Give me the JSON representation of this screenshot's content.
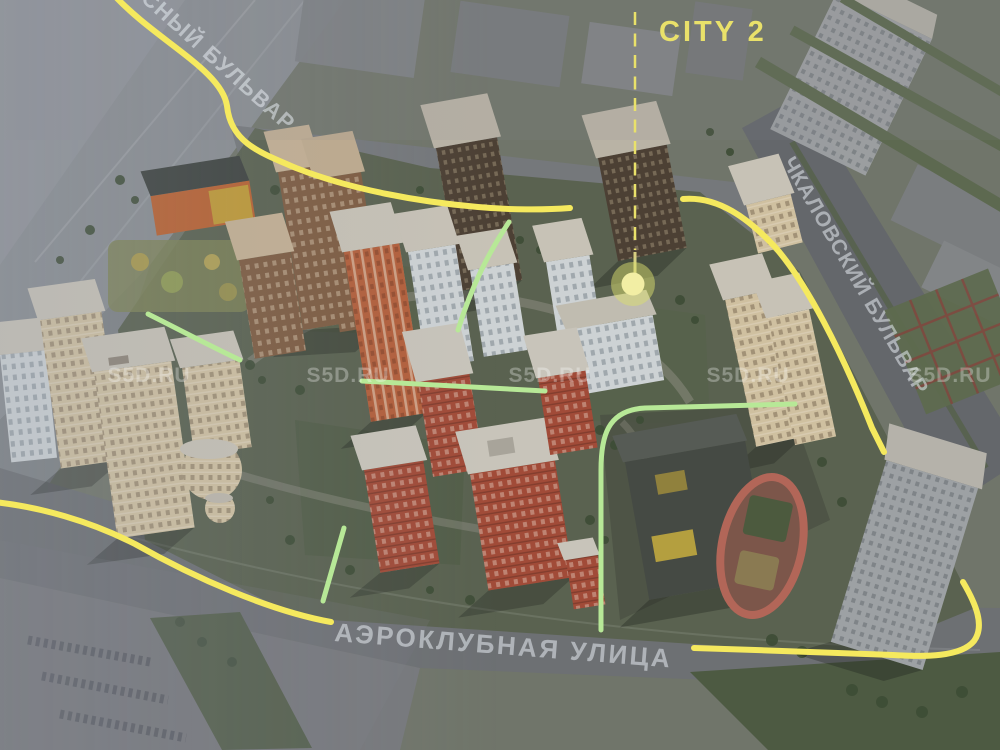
{
  "map": {
    "callout": {
      "label": "CITY 2",
      "color": "#E9E16A"
    },
    "streets": [
      {
        "id": "boulevard-top-left",
        "label": "СНЫЙ БУЛЬВАР"
      },
      {
        "id": "chkalovsky-boulevard",
        "label": "ЧКАЛОВСКИЙ БУЛЬВАР"
      },
      {
        "id": "aeroklubnaya-ulitsa",
        "label": "АЭРОКЛУБНАЯ УЛИЦА"
      }
    ],
    "watermark": {
      "text": "S5D.RU",
      "count": 5
    },
    "colors": {
      "route_yellow": "#F5E95E",
      "path_green": "#B7E897",
      "callout_yellow": "#E9E16A",
      "marker_inner": "#F2EEA4",
      "marker_outer": "#DADE6E"
    }
  }
}
